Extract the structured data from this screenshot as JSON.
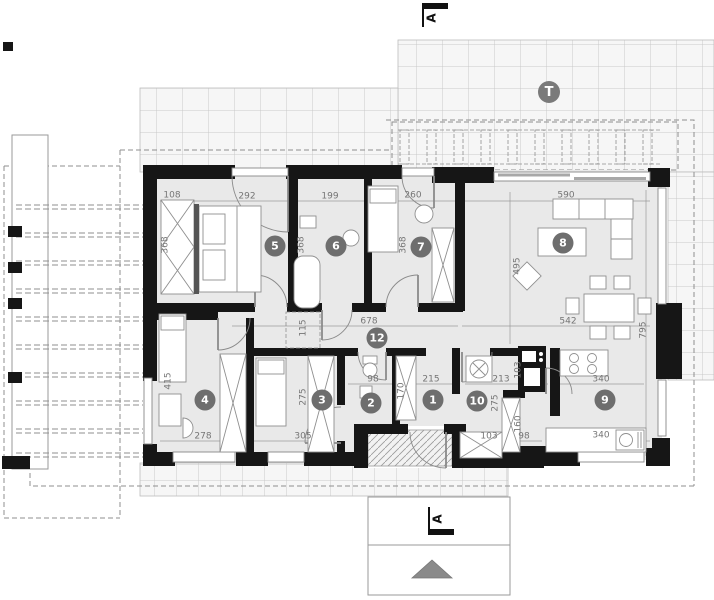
{
  "plan": {
    "terrace_label": "T",
    "section_marker_top": "A",
    "section_marker_bottom": "A"
  },
  "room_badges": [
    {
      "label": "5",
      "x": 275,
      "y": 246
    },
    {
      "label": "6",
      "x": 336,
      "y": 246
    },
    {
      "label": "7",
      "x": 421,
      "y": 247
    },
    {
      "label": "8",
      "x": 563,
      "y": 243
    },
    {
      "label": "12",
      "x": 377,
      "y": 338
    },
    {
      "label": "4",
      "x": 205,
      "y": 400
    },
    {
      "label": "3",
      "x": 322,
      "y": 400
    },
    {
      "label": "2",
      "x": 371,
      "y": 403
    },
    {
      "label": "1",
      "x": 433,
      "y": 400
    },
    {
      "label": "10",
      "x": 477,
      "y": 401
    },
    {
      "label": "9",
      "x": 605,
      "y": 400
    }
  ],
  "dimensions": [
    {
      "value": "108",
      "x": 172,
      "y": 196,
      "vertical": false
    },
    {
      "value": "292",
      "x": 247,
      "y": 197,
      "vertical": false
    },
    {
      "value": "199",
      "x": 330,
      "y": 197,
      "vertical": false
    },
    {
      "value": "260",
      "x": 413,
      "y": 196,
      "vertical": false
    },
    {
      "value": "590",
      "x": 566,
      "y": 196,
      "vertical": false
    },
    {
      "value": "368",
      "x": 166,
      "y": 245,
      "vertical": true
    },
    {
      "value": "368",
      "x": 302,
      "y": 245,
      "vertical": true
    },
    {
      "value": "368",
      "x": 404,
      "y": 245,
      "vertical": true
    },
    {
      "value": "495",
      "x": 518,
      "y": 266,
      "vertical": true
    },
    {
      "value": "795",
      "x": 644,
      "y": 330,
      "vertical": true
    },
    {
      "value": "678",
      "x": 369,
      "y": 322,
      "vertical": false
    },
    {
      "value": "542",
      "x": 568,
      "y": 322,
      "vertical": false
    },
    {
      "value": "115",
      "x": 304,
      "y": 328,
      "vertical": true
    },
    {
      "value": "415",
      "x": 169,
      "y": 381,
      "vertical": true
    },
    {
      "value": "275",
      "x": 304,
      "y": 397,
      "vertical": true
    },
    {
      "value": "170",
      "x": 402,
      "y": 391,
      "vertical": true
    },
    {
      "value": "103",
      "x": 519,
      "y": 370,
      "vertical": true
    },
    {
      "value": "275",
      "x": 496,
      "y": 403,
      "vertical": true
    },
    {
      "value": "160",
      "x": 519,
      "y": 424,
      "vertical": true
    },
    {
      "value": "98",
      "x": 373,
      "y": 380,
      "vertical": false
    },
    {
      "value": "215",
      "x": 431,
      "y": 380,
      "vertical": false
    },
    {
      "value": "213",
      "x": 501,
      "y": 380,
      "vertical": false
    },
    {
      "value": "340",
      "x": 601,
      "y": 380,
      "vertical": false
    },
    {
      "value": "278",
      "x": 203,
      "y": 437,
      "vertical": false
    },
    {
      "value": "305",
      "x": 303,
      "y": 437,
      "vertical": false
    },
    {
      "value": "103",
      "x": 489,
      "y": 437,
      "vertical": false
    },
    {
      "value": "98",
      "x": 524,
      "y": 437,
      "vertical": false
    },
    {
      "value": "340",
      "x": 601,
      "y": 436,
      "vertical": false
    }
  ],
  "colors": {
    "wall": "#161616",
    "room_fill": "#e9e9e9",
    "badge": "#6e6e6e",
    "dim_text": "#757575",
    "grid_line": "#c9c9c9",
    "north_arrow": "#8a8a8a"
  }
}
